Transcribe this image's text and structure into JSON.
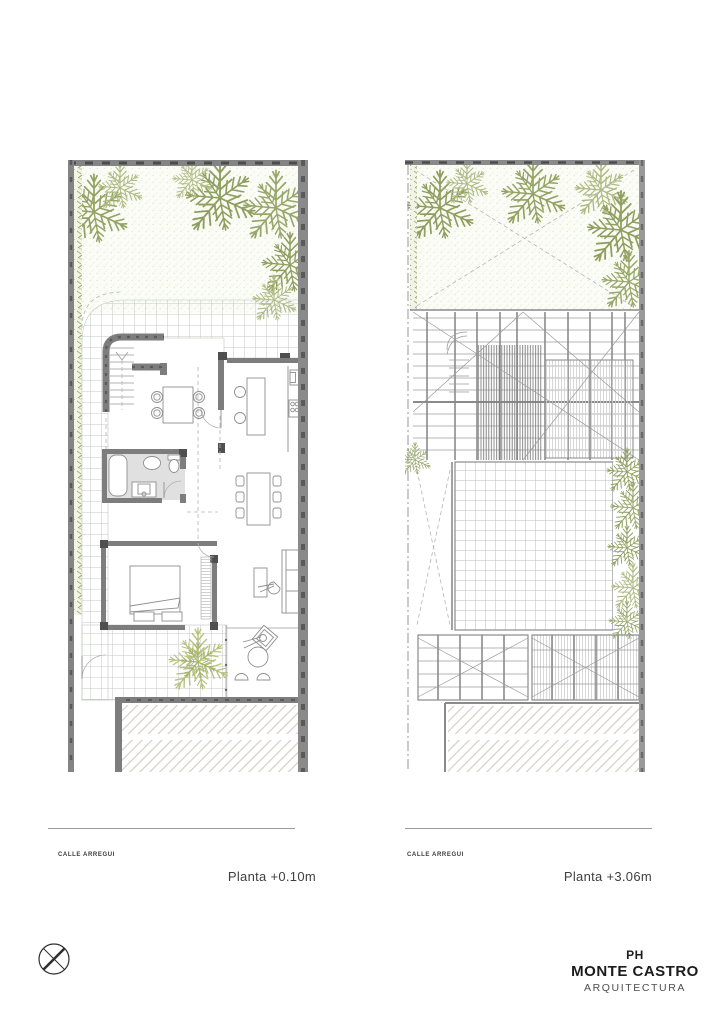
{
  "sheet": {
    "background": "#ffffff"
  },
  "plans": [
    {
      "id": "ground-floor",
      "title": "Planta +0.10m",
      "street_label": "CALLE ARREGUI"
    },
    {
      "id": "roof-level",
      "title": "Planta +3.06m",
      "street_label": "CALLE ARREGUI"
    }
  ],
  "logo": {
    "line1": "PH",
    "line2": "MONTE CASTRO",
    "line3": "ARQUITECTURA"
  },
  "icons": {
    "north_marker": "circle-x-marker"
  },
  "colors": {
    "wall_gray": "#848484",
    "wall_dark_speck": "#5a5a5a",
    "foliage_dark": "#8a9a58",
    "foliage_light": "#b3bf8a",
    "patio_tree": "#b8c27f",
    "garden_stipple": "#e2e6d4",
    "grid_line": "#c6cac4",
    "hatch_diagonal": "#d4cec9",
    "bathroom_floor": "#e0e0e0",
    "text": "#3f3f3f"
  }
}
